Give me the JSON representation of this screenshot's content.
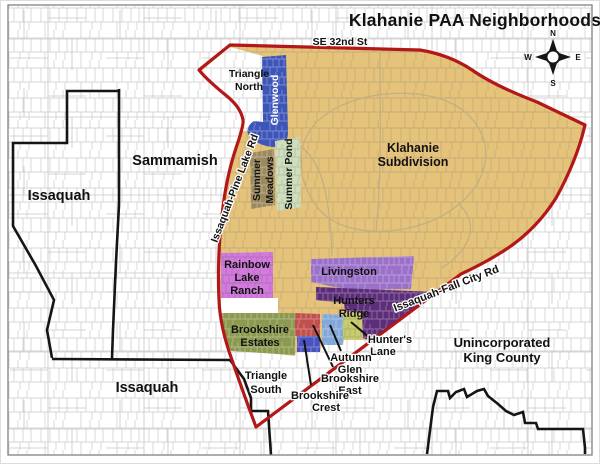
{
  "title": "Klahanie PAA Neighborhoods",
  "compass": {
    "n": "N",
    "e": "E",
    "s": "S",
    "w": "W"
  },
  "roads": [
    "SE 32nd St",
    "Issaquah-Pine Lake Rd",
    "Issaquah-Fall City Rd"
  ],
  "places": [
    "Sammamish",
    "Issaquah",
    "Unincorporated King County"
  ],
  "neighborhoods": [
    {
      "name": "Triangle North",
      "color_key": "triangle_white"
    },
    {
      "name": "Glenwood",
      "color_key": "glenwood"
    },
    {
      "name": "Summer Meadows",
      "color_key": "summer_meadows"
    },
    {
      "name": "Summer Pond",
      "color_key": "summer_pond"
    },
    {
      "name": "Klahanie Subdivision",
      "color_key": "klahanie"
    },
    {
      "name": "Rainbow Lake Ranch",
      "color_key": "rainbow_lake_ranch"
    },
    {
      "name": "Livingston",
      "color_key": "livingston"
    },
    {
      "name": "Hunters Ridge",
      "color_key": "hunters_ridge"
    },
    {
      "name": "Brookshire Estates",
      "color_key": "brookshire_estates"
    },
    {
      "name": "Triangle South",
      "color_key": "triangle_white"
    },
    {
      "name": "Brookshire Crest",
      "color_key": "brookshire_crest"
    },
    {
      "name": "Brookshire East",
      "color_key": "brookshire_east"
    },
    {
      "name": "Autumn Glen",
      "color_key": "autumn_glen"
    },
    {
      "name": "Hunter's Lane",
      "color_key": "hunters_lane"
    }
  ],
  "colors": {
    "paa_boundary_red": "#B21818",
    "city_boundary_black": "#151515",
    "parcel_gray": "#CACACA",
    "triangle_white": "#FFFFFF",
    "klahanie": "#E6C37B",
    "glenwood": "#3D55B8",
    "summer_pond": "#CFDFBE",
    "summer_meadows": "#9C8A5F",
    "rainbow_lake_ranch": "#D17BDC",
    "livingston": "#9A70C9",
    "hunters_ridge": "#5C2D78",
    "brookshire_estates": "#8B9A4F",
    "brookshire_east": "#C0504D",
    "brookshire_crest": "#4A52C0",
    "autumn_glen": "#82A8DA",
    "hunters_lane": "#C8CC6E"
  },
  "labels": {
    "title": "Klahanie PAA Neighborhoods",
    "se32nd": "SE 32nd St",
    "pine_lake_rd": "Issaquah-Pine Lake Rd",
    "fall_city_rd": "Issaquah-Fall City Rd",
    "sammamish": "Sammamish",
    "issaquah_nw": "Issaquah",
    "issaquah_s": "Issaquah",
    "unincorporated_1": "Unincorporated",
    "unincorporated_2": "King County",
    "triangle_north_1": "Triangle",
    "triangle_north_2": "North",
    "glenwood": "Glenwood",
    "summer_meadows_1": "Summer",
    "summer_meadows_2": "Meadows",
    "summer_pond": "Summer Pond",
    "klahanie_1": "Klahanie",
    "klahanie_2": "Subdivision",
    "rainbow_1": "Rainbow",
    "rainbow_2": "Lake",
    "rainbow_3": "Ranch",
    "livingston": "Livingston",
    "hunters_ridge_1": "Hunters",
    "hunters_ridge_2": "Ridge",
    "brookshire_estates_1": "Brookshire",
    "brookshire_estates_2": "Estates",
    "triangle_south_1": "Triangle",
    "triangle_south_2": "South",
    "brookshire_crest_1": "Brookshire",
    "brookshire_crest_2": "Crest",
    "brookshire_east_1": "Brookshire",
    "brookshire_east_2": "East",
    "autumn_glen_1": "Autumn",
    "autumn_glen_2": "Glen",
    "hunters_lane_1": "Hunter's",
    "hunters_lane_2": "Lane"
  }
}
